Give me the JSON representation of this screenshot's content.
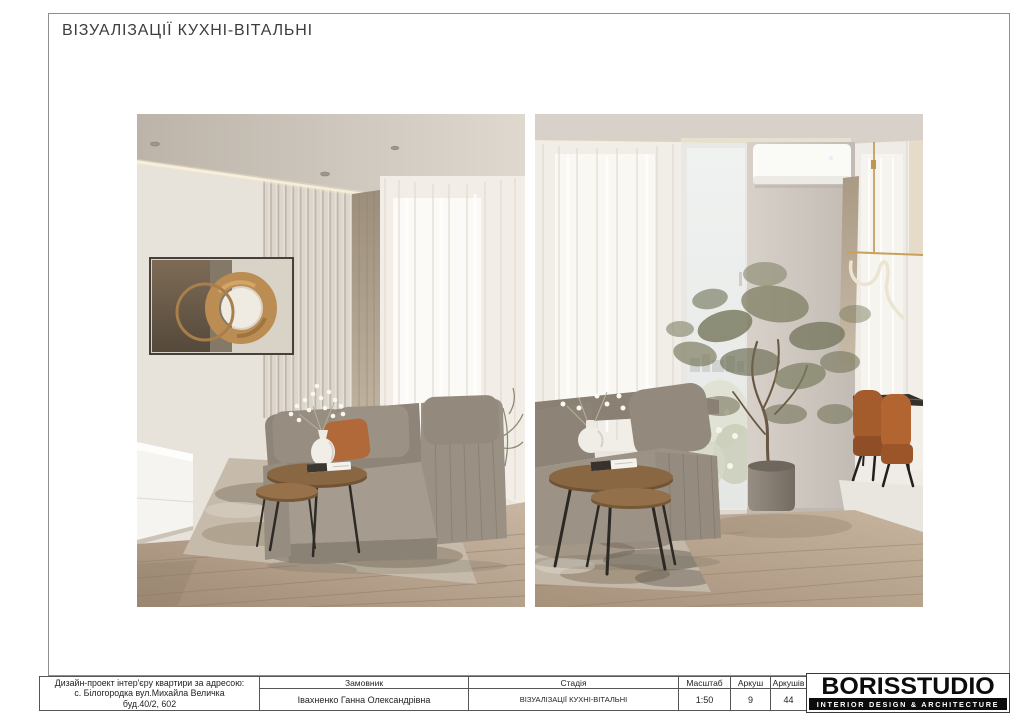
{
  "page": {
    "title": "ВІЗУАЛІЗАЦІЇ КУХНІ-ВІТАЛЬНІ"
  },
  "renders": [
    {
      "id": "view-1"
    },
    {
      "id": "view-2"
    }
  ],
  "title_block": {
    "project_address": {
      "line1": "Дизайн-проект інтер'єру квартири за адресою:",
      "line2": "с. Білогородка вул.Михайла Величка",
      "line3": "буд.40/2, 602"
    },
    "customer": {
      "header": "Замовник",
      "value": "Івахненко Ганна Олександрівна"
    },
    "stage": {
      "header": "Стадія",
      "value": "ВІЗУАЛІЗАЦІЇ КУХНІ-ВІТАЛЬНІ"
    },
    "scale": {
      "header": "Масштаб",
      "value": "1:50"
    },
    "sheet": {
      "header": "Аркуш",
      "value": "9"
    },
    "sheets_total": {
      "header": "Аркушів",
      "value": "44"
    }
  },
  "logo": {
    "name": "BORISSTUDIO",
    "tagline": "INTERIOR DESIGN & ARCHITECTURE"
  },
  "colors": {
    "wood_table": "#8a6743",
    "sofa": "#948b7f",
    "accent_pillow": "#b2693a",
    "dining_chair": "#a85d2f",
    "brass": "#bc8d52",
    "logo_bar": "#0c0c0c"
  }
}
